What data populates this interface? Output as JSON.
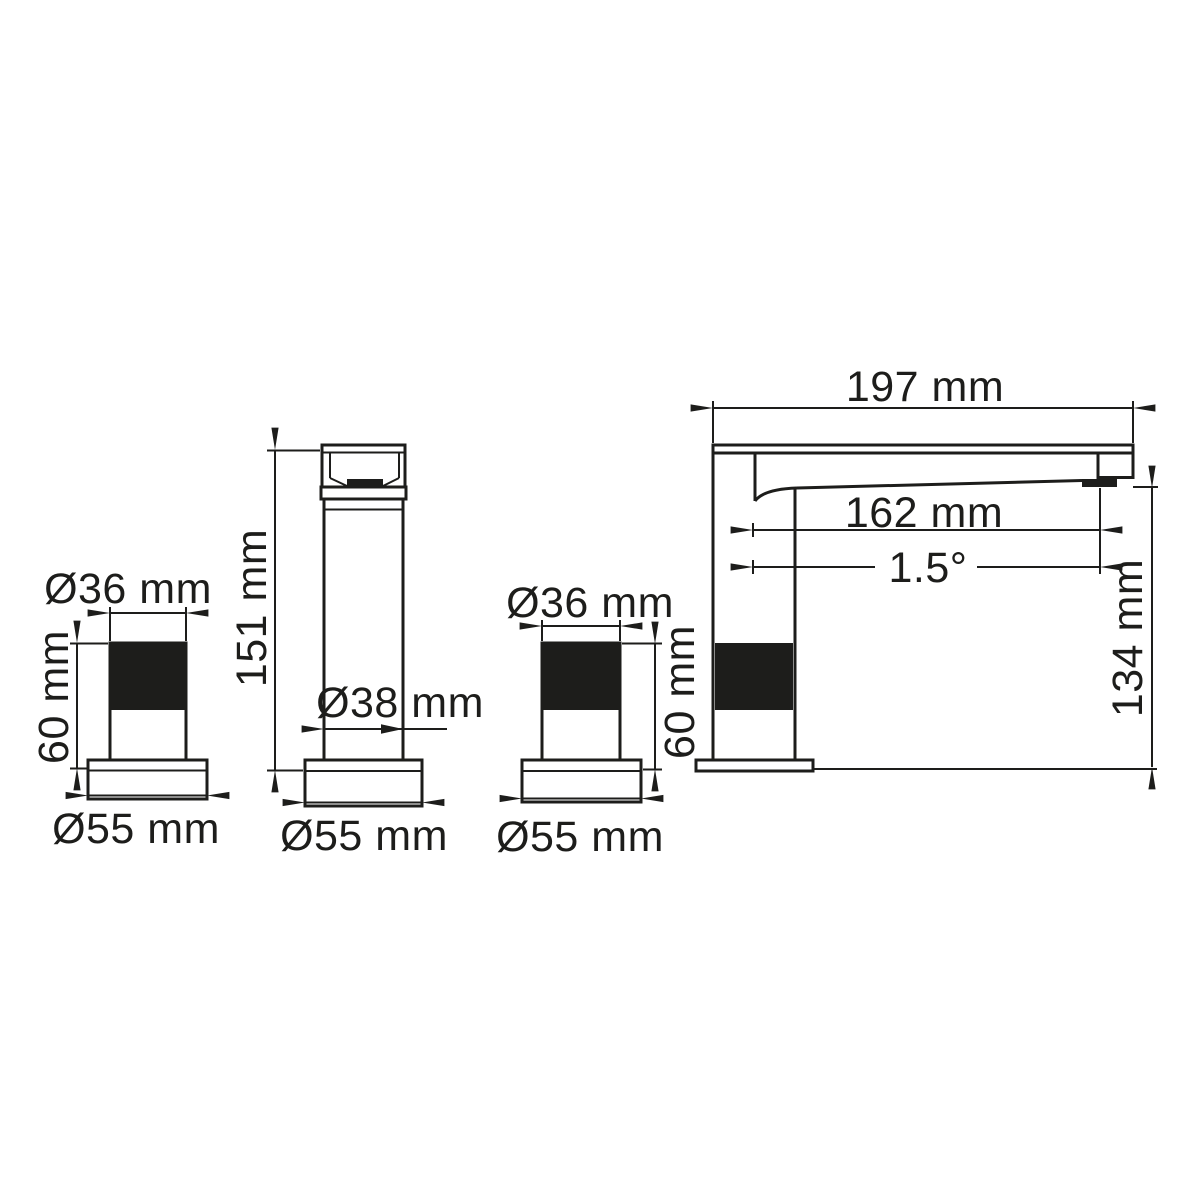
{
  "colors": {
    "line": "#1d1d1b",
    "background": "#ffffff",
    "knurl_fill": "#1d1d1b"
  },
  "figures": {
    "handle_left": {
      "top_diameter": "Ø36 mm",
      "height": "60 mm",
      "base_diameter": "Ø55 mm"
    },
    "spout_column": {
      "height": "151 mm",
      "body_diameter": "Ø38 mm",
      "base_diameter": "Ø55 mm"
    },
    "handle_right": {
      "top_diameter": "Ø36 mm",
      "height": "60 mm",
      "base_diameter": "Ø55 mm"
    },
    "faucet": {
      "total_length": "197 mm",
      "spout_reach": "162 mm",
      "spout_angle": "1.5°",
      "height": "134 mm"
    }
  }
}
